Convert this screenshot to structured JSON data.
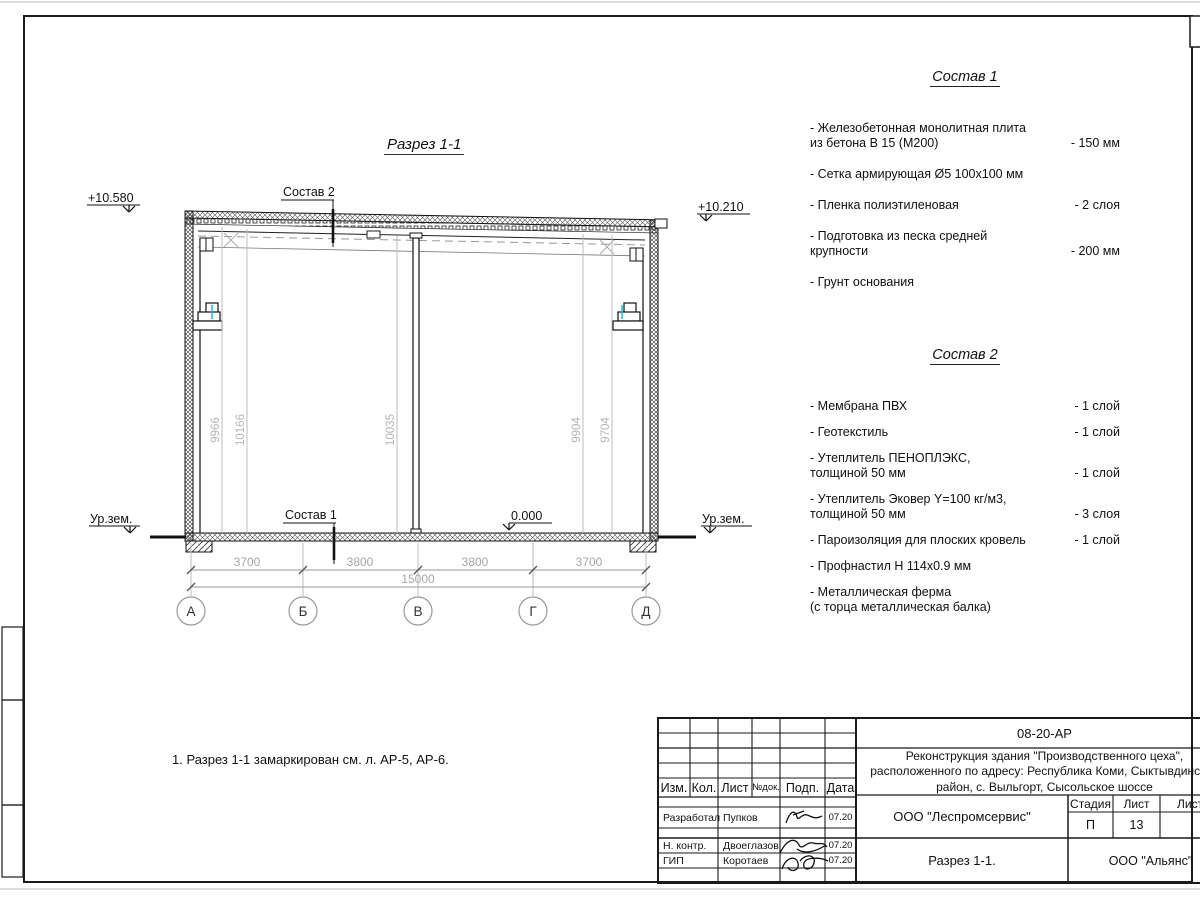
{
  "drawing_title": "Разрез 1-1",
  "note": "1. Разрез 1-1 замаркирован см. л. АР-5, АР-6.",
  "leaders": {
    "sostav1": "Состав 1",
    "sostav2": "Состав 2"
  },
  "elevations": {
    "top_left": "+10.580",
    "top_right": "+10.210",
    "zero": "0.000",
    "ground_left": "Ур.зем.",
    "ground_right": "Ур.зем."
  },
  "axes": {
    "labels": [
      "А",
      "Б",
      "В",
      "Г",
      "Д"
    ],
    "spans": [
      "3700",
      "3800",
      "3800",
      "3700"
    ],
    "total": "15000"
  },
  "vertical_dims": [
    "9966",
    "10166",
    "10035",
    "9904",
    "9704"
  ],
  "sostav1": {
    "title": "Состав 1",
    "items": [
      {
        "name": "- Железобетонная  монолитная плита\n  из бетона В 15 (М200)",
        "value": "- 150 мм"
      },
      {
        "name": "- Сетка армирующая Ø5 100х100 мм",
        "value": ""
      },
      {
        "name": "- Пленка полиэтиленовая",
        "value": "-  2 слоя"
      },
      {
        "name": "- Подготовка из песка средней\n  крупности",
        "value": "- 200 мм"
      },
      {
        "name": "- Грунт основания",
        "value": ""
      }
    ]
  },
  "sostav2": {
    "title": "Состав 2",
    "items": [
      {
        "name": "- Мембрана ПВХ",
        "value": "- 1 слой"
      },
      {
        "name": "- Геотекстиль",
        "value": "- 1 слой"
      },
      {
        "name": "- Утеплитель ПЕНОПЛЭКС,\n  толщиной 50 мм",
        "value": "- 1 слой"
      },
      {
        "name": "- Утеплитель Эковер Y=100 кг/м3,\n  толщиной 50 мм",
        "value": "- 3 слоя"
      },
      {
        "name": "- Пароизоляция для плоских кровель",
        "value": "- 1 слой"
      },
      {
        "name": "- Профнастил Н 114х0.9 мм",
        "value": ""
      },
      {
        "name": "- Металлическая ферма\n  (с торца металлическая балка)",
        "value": ""
      }
    ]
  },
  "titleblock": {
    "doc_code": "08-20-АР",
    "project": "Реконструкция здания \"Производственного цеха\",\nрасположенного по адресу: Республика Коми, Сыктывдинский\nрайон, с. Выльгорт, Сысольское шоссе",
    "header_cols": [
      "Изм.",
      "Кол.",
      "Лист",
      "№док.",
      "Подп.",
      "Дата"
    ],
    "rows": [
      {
        "role": "Разработал",
        "name": "Пупков",
        "date": "07.20"
      },
      {
        "role": "Н. контр.",
        "name": "Двоеглазов",
        "date": "07.20"
      },
      {
        "role": "ГИП",
        "name": "Коротаев",
        "date": "07.20"
      }
    ],
    "org": "ООО \"Леспромсервис\"",
    "stage_label": "Стадия",
    "sheet_label": "Лист",
    "sheets_label": "Листов",
    "stage": "П",
    "sheet_no": "13",
    "sheet_title": "Разрез 1-1.",
    "contractor": "ООО \"Альянс\""
  },
  "colors": {
    "line_black": "#111111",
    "dim_gray": "#a6a6a6",
    "accent_cyan": "#2ab8c6"
  }
}
